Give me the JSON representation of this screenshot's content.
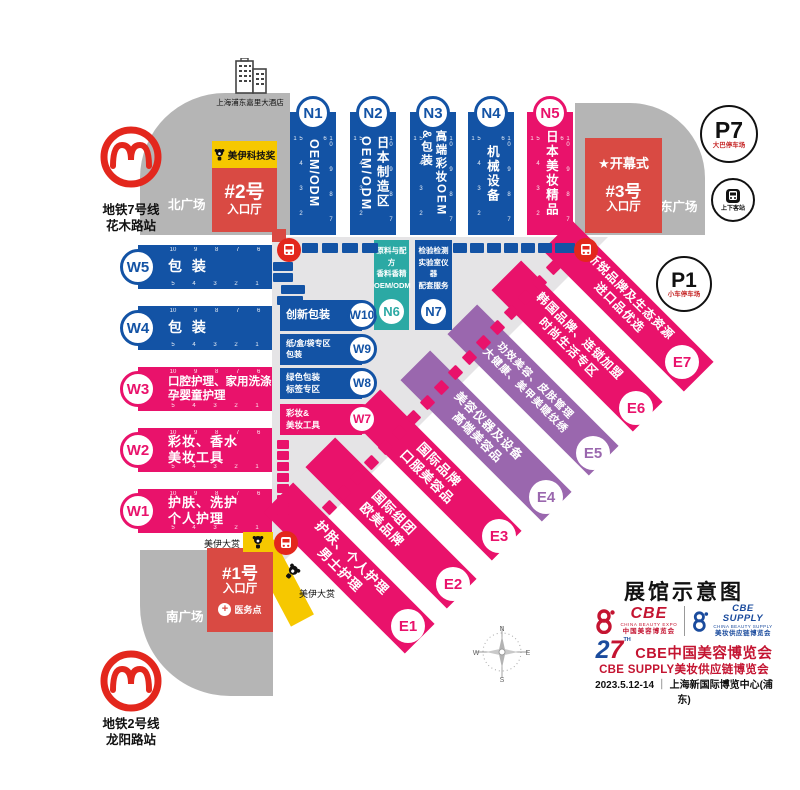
{
  "map": {
    "title": "展馆示意图",
    "hotel": "上海浦东嘉里大酒店",
    "metro7": {
      "line": "地铁7号线",
      "station": "花木路站"
    },
    "metro2": {
      "line": "地铁2号线",
      "station": "龙阳路站"
    },
    "plazas": {
      "north": "北广场",
      "east": "东广场",
      "south": "南广场"
    },
    "entrances": {
      "no1": {
        "num": "#1号",
        "hall": "入口厅"
      },
      "no2": {
        "num": "#2号",
        "hall": "入口厅"
      },
      "no3": {
        "num": "#3号",
        "hall": "入口厅"
      }
    },
    "opening": "开幕式",
    "parking": {
      "p7": {
        "code": "P7",
        "desc": "大巴停车场"
      },
      "p1": {
        "code": "P1",
        "desc": "小车停车场"
      }
    },
    "bus_stop": "上下客站",
    "medical": "医务点",
    "award_tech": "美伊科技奖",
    "award_grand": "美伊大赏",
    "compass": {
      "n": "N",
      "e": "E",
      "s": "S",
      "w": "W"
    }
  },
  "icons": {
    "star": "★",
    "cross": "+"
  },
  "halls": {
    "n": [
      {
        "id": "N1",
        "label": "OEM/ODM"
      },
      {
        "id": "N2",
        "label": "日本制造区\nOEM/ODM"
      },
      {
        "id": "N3",
        "label": "高端彩妆OEM\n&包装"
      },
      {
        "id": "N4",
        "label": "机械设备"
      },
      {
        "id": "N5",
        "label": "日本美妆精品"
      }
    ],
    "w": [
      {
        "id": "W1",
        "label": "护肤、洗护\n个人护理"
      },
      {
        "id": "W2",
        "label": "彩妆、香水\n美妆工具"
      },
      {
        "id": "W3",
        "label": "口腔护理、家用洗涤\n孕婴童护理"
      },
      {
        "id": "W4",
        "label": "包 装"
      },
      {
        "id": "W5",
        "label": "包 装"
      }
    ],
    "mid": [
      {
        "id": "W10",
        "label": "创新包装"
      },
      {
        "id": "W9",
        "label": "纸/盒/袋专区\n包装"
      },
      {
        "id": "W8",
        "label": "绿色包装\n标签专区"
      },
      {
        "id": "W7",
        "label": "彩妆&\n美妆工具"
      }
    ],
    "n67": [
      {
        "id": "N6",
        "label": "原料与配方\n香料香精\nOEM/ODM"
      },
      {
        "id": "N7",
        "label": "检验检测\n实验室仪器\n配套服务"
      }
    ],
    "e": [
      {
        "id": "E1",
        "label": "护肤、个人护理\n男士护理"
      },
      {
        "id": "E2",
        "label": "国际组团\n欧美品牌"
      },
      {
        "id": "E3",
        "label": "国际品牌\n口服美容品"
      },
      {
        "id": "E4",
        "label": "美容仪器及设备\n高端美容品"
      },
      {
        "id": "E5",
        "label": "功效美容、皮肤管理\n大健康、美甲美睫纹绣"
      },
      {
        "id": "E6",
        "label": "韩国品牌、连锁加盟\n时尚生活专区"
      },
      {
        "id": "E7",
        "label": "新锐品牌及生态资源\n进口品优选"
      }
    ]
  },
  "ticks": {
    "desc": "10 9 8 7 6",
    "asc": "5 4 3 2 1"
  },
  "footer": {
    "cbe": {
      "name": "CBE",
      "en": "CHINA BEAUTY EXPO",
      "cn": "中国美容博览会"
    },
    "supply": {
      "name1": "CBE",
      "name2": "SUPPLY",
      "en": "CHINA BEAUTY SUPPLY",
      "cn": "美妆供应链博览会"
    },
    "edition_2": "2",
    "edition_7": "7",
    "edition_th": "TH",
    "event1": "CBE中国美容博览会",
    "event2": "CBE SUPPLY美妆供应链博览会",
    "date": "2023.5.12-14",
    "sep": "｜",
    "venue": "上海新国际博览中心(浦东)"
  },
  "colors": {
    "hall_blue": "#1353A5",
    "hall_pink": "#E9126B",
    "hall_purple": "#9A67AE",
    "hall_teal": "#2BA9A4",
    "entrance_red": "#D94A43",
    "bus_red": "#E3271D",
    "award_yellow": "#F6C800",
    "plaza_gray": "#B5B5B5",
    "floor_gray": "#E5E4E6",
    "cbe_red": "#C41431",
    "cbe_blue": "#1A4B9D"
  }
}
